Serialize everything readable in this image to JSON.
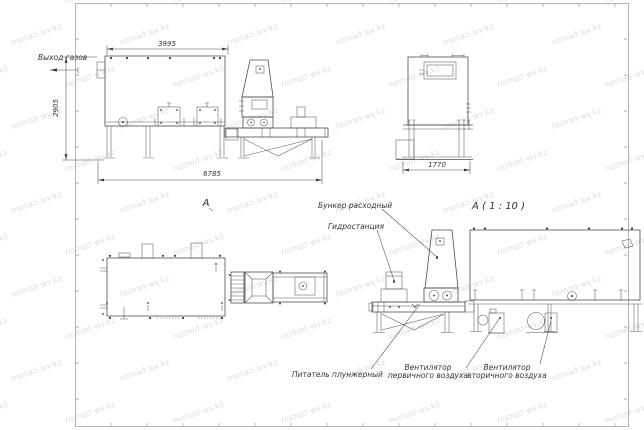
{
  "watermark": {
    "text": "nomad-wv.kz",
    "color": "#b9c6d2"
  },
  "labels": {
    "gas_outlet": "Выход газов",
    "view_a": "А",
    "view_a_detail": "А ( 1 : 10 )",
    "hopper": "Бункер расходный",
    "hydro": "Гидростанция",
    "feeder": "Питатель плунжерный",
    "fan_primary_1": "Вентилятор",
    "fan_primary_2": "первичного воздуха",
    "fan_secondary_1": "Вентилятор",
    "fan_secondary_2": "вторичного воздуха"
  },
  "dimensions": {
    "top_width": "3995",
    "left_height": "2905",
    "total_length": "6785",
    "front_width": "1770"
  },
  "style": {
    "line_color": "#4d4d4d",
    "frame_color": "#a9aeb4"
  }
}
